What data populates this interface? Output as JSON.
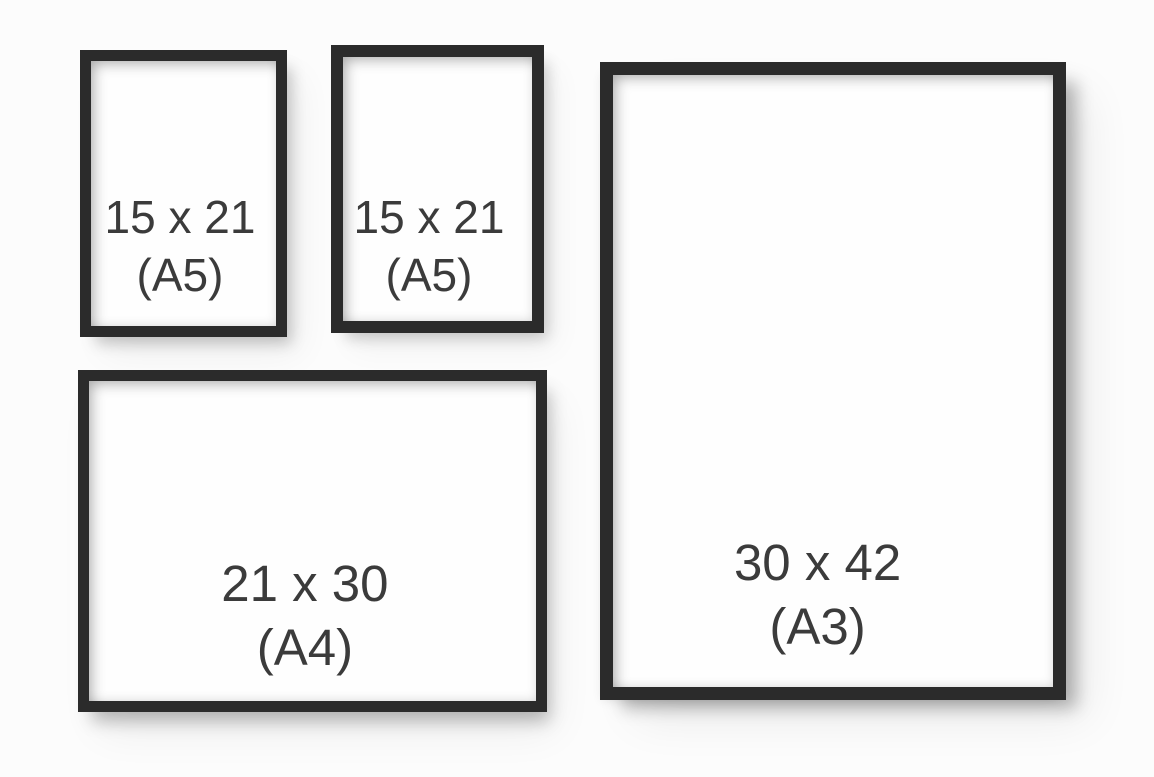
{
  "colors": {
    "background": "#fcfcfc",
    "frame_border": "#2b2b2b",
    "paper": "#fefefe",
    "label_text": "#3b3b3b"
  },
  "frames": [
    {
      "position": "top-left",
      "orientation": "portrait",
      "size": "15 x 21",
      "format": "(A5)"
    },
    {
      "position": "top-middle",
      "orientation": "portrait",
      "size": "15 x 21",
      "format": "(A5)"
    },
    {
      "position": "right",
      "orientation": "portrait",
      "size": "30 x 42",
      "format": "(A3)"
    },
    {
      "position": "bottom-left",
      "orientation": "landscape",
      "size": "21 x 30",
      "format": "(A4)"
    }
  ]
}
